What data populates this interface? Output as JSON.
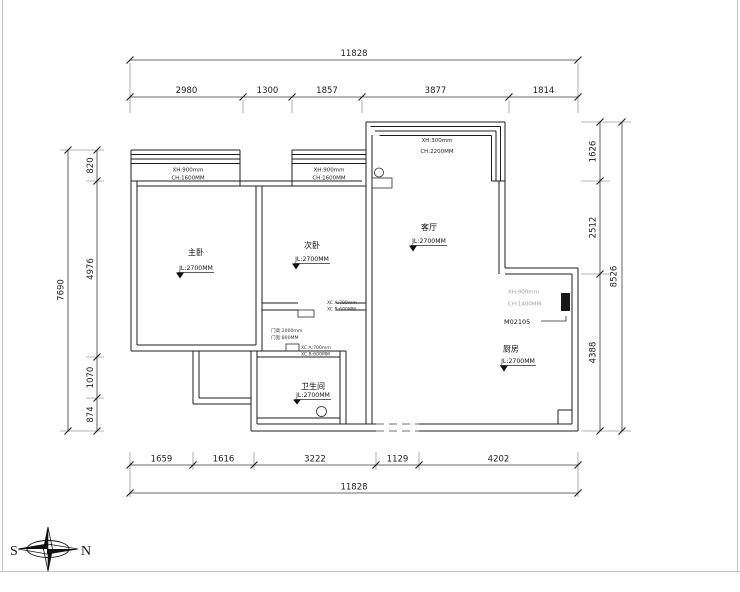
{
  "dimensions": {
    "top": {
      "total": "11828",
      "segments": [
        "2980",
        "1300",
        "1857",
        "3877",
        "1814"
      ]
    },
    "bottom": {
      "total": "11828",
      "segments": [
        "1659",
        "1616",
        "3222",
        "1129",
        "4202"
      ]
    },
    "left": {
      "total": "7690",
      "segments": [
        "820",
        "4976",
        "1070",
        "874"
      ]
    },
    "right": {
      "total": "8526",
      "segments": [
        "1626",
        "2512",
        "4388"
      ]
    }
  },
  "rooms": {
    "master": {
      "name": "主卧",
      "height_note": "JL:2700MM"
    },
    "second": {
      "name": "次卧",
      "height_note": "JL:2700MM"
    },
    "living": {
      "name": "客厅",
      "height_note": "JL:2700MM"
    },
    "kitchen": {
      "name": "厨房",
      "height_note": "JL:2700MM"
    },
    "bathroom": {
      "name": "卫生间",
      "height_note": "JL:2700MM"
    }
  },
  "windows": {
    "master": {
      "line1": "XH:900mm",
      "line2": "CH:1600MM"
    },
    "second": {
      "line1": "XH:900mm",
      "line2": "CH:1600MM"
    },
    "bay": {
      "line1": "XH:300mm",
      "line2": "CH:2200MM"
    },
    "kitchen": {
      "line1": "XH:900mm",
      "line2": "CH:1400MM"
    }
  },
  "tags": {
    "door_tag": "M02105"
  },
  "small_notes": {
    "hall_window_1": "XC A:700mm",
    "hall_window_2": "XC B:600MM",
    "door_size_1": "门高:2000mm",
    "door_size_2": "门宽:800MM",
    "bath_window_1": "XC A:700mm",
    "bath_window_2": "XC B:600MM"
  },
  "compass": {
    "west_label": "S",
    "east_label": "N"
  }
}
